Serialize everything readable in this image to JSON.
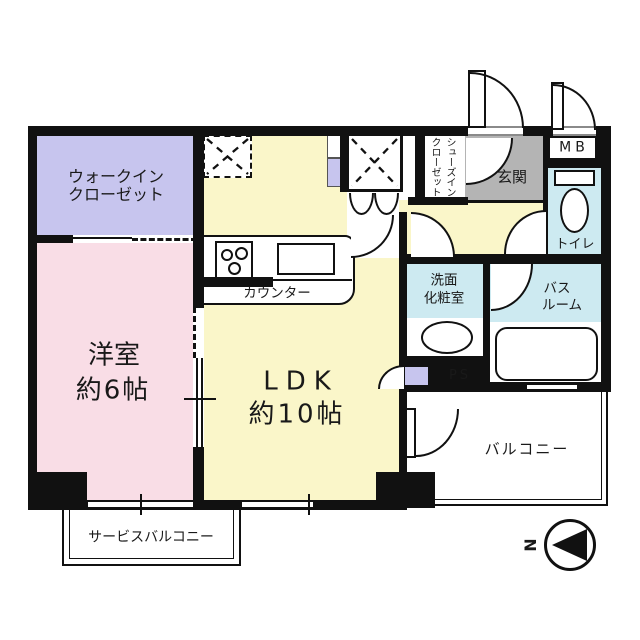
{
  "palette": {
    "wall": "#111111",
    "bedroom_pink": "#f9dde6",
    "ldk_yellow": "#faf6c9",
    "closet_lavender": "#c7c5ee",
    "wet_area_blue": "#cdeaf1",
    "genkan_gray": "#b4b4b4",
    "background": "#ffffff"
  },
  "rooms": {
    "walk_in_closet": {
      "label_line1": "ウォークイン",
      "label_line2": "クローゼット"
    },
    "bedroom": {
      "name": "洋室",
      "size": "約6帖"
    },
    "ldk": {
      "name": "LDK",
      "size": "約10帖"
    },
    "kitchen": {
      "counter_label": "カウンター"
    },
    "shoes_closet": {
      "label_line1": "シューズイン",
      "label_line2": "クローゼット"
    },
    "entrance": {
      "label": "玄関"
    },
    "meter_box": {
      "label": "MB"
    },
    "toilet": {
      "label": "トイレ"
    },
    "washroom": {
      "label_line1": "洗面",
      "label_line2": "化粧室"
    },
    "bathroom": {
      "label_line1": "バス",
      "label_line2": "ルーム"
    },
    "pipe_space": {
      "label": "PS"
    },
    "balcony": {
      "label": "バルコニー"
    },
    "service_balcony": {
      "label": "サービスバルコニー"
    }
  },
  "compass": {
    "north_label": "N"
  }
}
